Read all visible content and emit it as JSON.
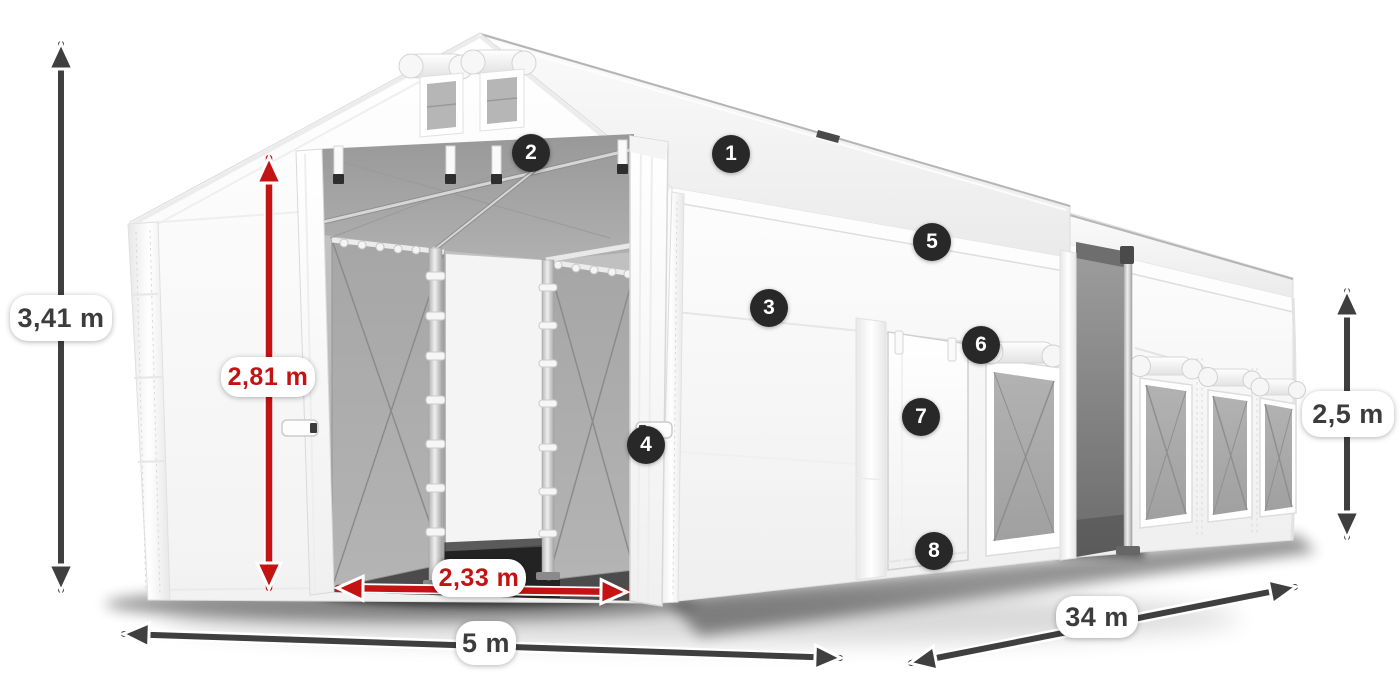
{
  "page": {
    "background": "#ffffff",
    "description": "Dimension diagram of a white PVC storage tent with numbered feature markers"
  },
  "colors": {
    "dimension_arrow_gray": "#3f3f3f",
    "dimension_arrow_red": "#c41313",
    "label_text_gray": "#3c3c3c",
    "label_text_red": "#c41313",
    "label_background": "#ffffff",
    "marker_background": "#282828",
    "marker_text": "#ffffff",
    "tent_fabric": "#ffffff",
    "interior_mesh_gray": "#a8a8a8"
  },
  "dimensions": {
    "total_height": {
      "value": "3,41 m"
    },
    "entrance_height": {
      "value": "2,81 m"
    },
    "entrance_width": {
      "value": "2,33 m"
    },
    "front_width": {
      "value": "5 m"
    },
    "side_length": {
      "value": "34 m"
    },
    "side_wall_height": {
      "value": "2,5 m"
    }
  },
  "markers": [
    {
      "label": "1"
    },
    {
      "label": "2"
    },
    {
      "label": "3"
    },
    {
      "label": "4"
    },
    {
      "label": "5"
    },
    {
      "label": "6"
    },
    {
      "label": "7"
    },
    {
      "label": "8"
    }
  ]
}
